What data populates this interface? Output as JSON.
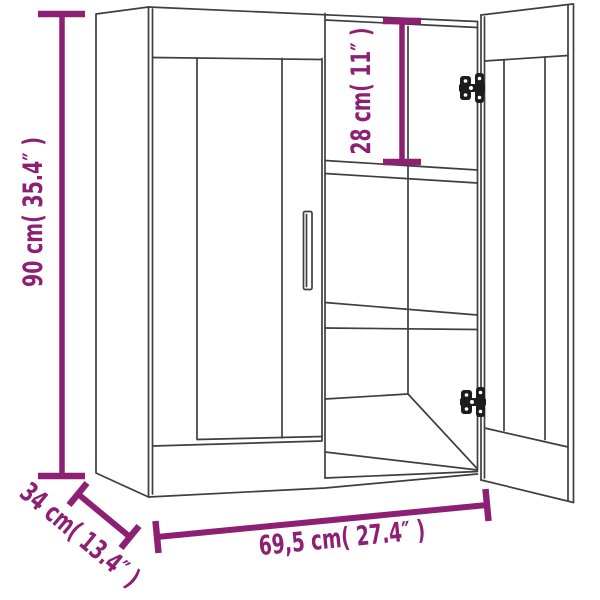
{
  "diagram": {
    "kind": "product-dimension-diagram",
    "product": "wall-cabinet-two-doors-open-right-door",
    "labels": {
      "height": "90 cm( 35.4″ )",
      "top_compartment": "28 cm( 11″ )",
      "width": "69,5 cm( 27.4″ )",
      "depth": "34 cm( 13.4″ )"
    },
    "values": {
      "height_cm": "90",
      "height_in": "35.4",
      "top_compartment_cm": "28",
      "top_compartment_in": "11",
      "width_cm": "69,5",
      "width_in": "27.4",
      "depth_cm": "34",
      "depth_in": "13.4"
    },
    "colors": {
      "dimension": "#8d2072",
      "outline": "#3f3f3f",
      "hardware": "#1c1c1c",
      "background": "#ffffff"
    }
  }
}
